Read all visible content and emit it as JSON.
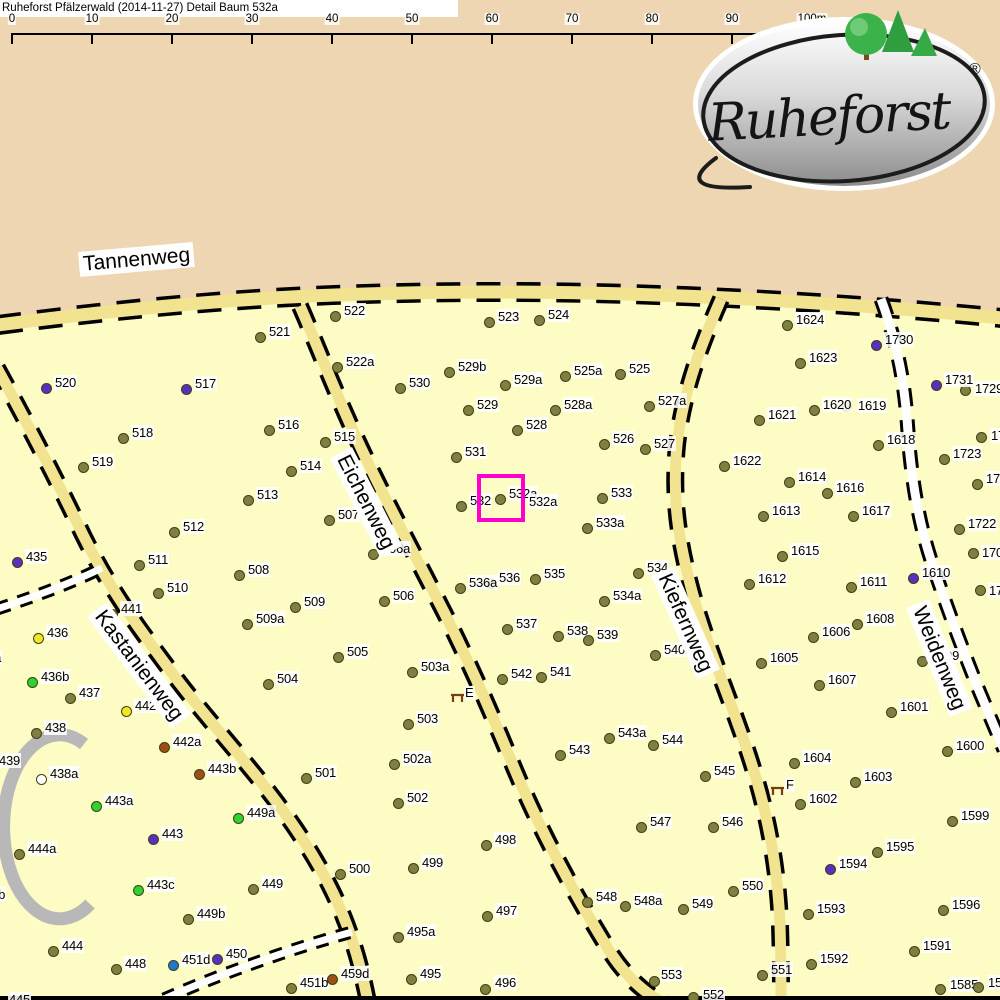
{
  "header": {
    "title": "Ruheforst Pfälzerwald (2014-11-27) Detail  Baum 532a"
  },
  "scale_bar": {
    "tick_labels": [
      "0",
      "10",
      "20",
      "30",
      "40",
      "50",
      "60",
      "70",
      "80",
      "90",
      "100m"
    ],
    "start_x": 12,
    "step_px": 80
  },
  "logo": {
    "text": "Ruheforst",
    "registered": "®"
  },
  "map": {
    "colors": {
      "olive": "#80803e",
      "purple": "#5b2fbe",
      "green": "#2fd32f",
      "yellow": "#f2e623",
      "brown": "#9b4f12",
      "blue": "#2277cc",
      "open": "#ffffff",
      "dot_border": "#3e3e1c",
      "highlight": "#ff00cc",
      "road_yellow": "#f1e38f",
      "forest_bg": "#fcfcc4",
      "outside_bg": "#efd6b2"
    },
    "roads": [
      {
        "name": "Tannenweg",
        "label": {
          "x": 78,
          "y": 252,
          "rot": -5
        }
      },
      {
        "name": "Eichenweg",
        "label": {
          "x": 352,
          "y": 447,
          "rot": 63
        }
      },
      {
        "name": "Kastanienweg",
        "label": {
          "x": 107,
          "y": 602,
          "rot": 53
        }
      },
      {
        "name": "Kiefernweg",
        "label": {
          "x": 674,
          "y": 566,
          "rot": 66
        }
      },
      {
        "name": "Weidenweg",
        "label": {
          "x": 929,
          "y": 599,
          "rot": 68
        }
      }
    ],
    "highlight": {
      "tree": "532a",
      "x": 477,
      "y": 474,
      "w": 48,
      "h": 48
    },
    "benches": [
      {
        "letter": "E",
        "x": 450,
        "y": 692,
        "lx": 464,
        "ly": 686
      },
      {
        "letter": "F",
        "x": 770,
        "y": 785,
        "lx": 785,
        "ly": 778
      }
    ],
    "trees": [
      [
        "435",
        17,
        562,
        "purple"
      ],
      [
        "436",
        38,
        638,
        "yellow"
      ],
      [
        "436a",
        -36,
        663,
        "olive"
      ],
      [
        "436b",
        32,
        682,
        "green"
      ],
      [
        "437",
        70,
        698,
        "olive"
      ],
      [
        "438",
        36,
        733,
        "olive"
      ],
      [
        "438a",
        41,
        779,
        "open"
      ],
      [
        "439",
        -10,
        766,
        "olive"
      ],
      [
        "441",
        112,
        614,
        "brown"
      ],
      [
        "442",
        126,
        711,
        "yellow"
      ],
      [
        "442a",
        164,
        747,
        "brown"
      ],
      [
        "443",
        153,
        839,
        "purple"
      ],
      [
        "443a",
        96,
        806,
        "green"
      ],
      [
        "443b",
        199,
        774,
        "brown"
      ],
      [
        "443c",
        138,
        890,
        "green"
      ],
      [
        "444",
        53,
        951,
        "olive"
      ],
      [
        "444a",
        19,
        854,
        "olive"
      ],
      [
        "444b",
        -32,
        900,
        "olive"
      ],
      [
        "445",
        0,
        1005,
        "olive"
      ],
      [
        "448",
        116,
        969,
        "olive"
      ],
      [
        "449",
        253,
        889,
        "olive"
      ],
      [
        "449a",
        238,
        818,
        "green"
      ],
      [
        "449b",
        188,
        919,
        "olive"
      ],
      [
        "450",
        217,
        959,
        "purple"
      ],
      [
        "451b",
        291,
        988,
        "olive"
      ],
      [
        "451d",
        173,
        965,
        "blue"
      ],
      [
        "459d",
        332,
        979,
        "brown"
      ],
      [
        "495",
        411,
        979,
        "olive"
      ],
      [
        "495a",
        398,
        937,
        "olive"
      ],
      [
        "496",
        485,
        989,
        "olive",
        9,
        -14
      ],
      [
        "497",
        487,
        916,
        "olive"
      ],
      [
        "498",
        486,
        845,
        "olive"
      ],
      [
        "499",
        413,
        868,
        "olive"
      ],
      [
        "500",
        340,
        874,
        "olive"
      ],
      [
        "501",
        306,
        778,
        "olive"
      ],
      [
        "502",
        398,
        803,
        "olive"
      ],
      [
        "502a",
        394,
        764,
        "olive"
      ],
      [
        "503",
        408,
        724,
        "olive"
      ],
      [
        "503a",
        412,
        672,
        "olive"
      ],
      [
        "504",
        268,
        684,
        "olive"
      ],
      [
        "505",
        338,
        657,
        "olive"
      ],
      [
        "506",
        384,
        601,
        "olive"
      ],
      [
        "506a",
        373,
        554,
        "olive"
      ],
      [
        "507",
        329,
        520,
        "olive"
      ],
      [
        "508",
        239,
        575,
        "olive"
      ],
      [
        "509",
        295,
        607,
        "olive"
      ],
      [
        "509a",
        247,
        624,
        "olive"
      ],
      [
        "510",
        158,
        593,
        "olive"
      ],
      [
        "511",
        139,
        565,
        "olive"
      ],
      [
        "512",
        174,
        532,
        "olive"
      ],
      [
        "513",
        248,
        500,
        "olive"
      ],
      [
        "514",
        291,
        471,
        "olive"
      ],
      [
        "515",
        325,
        442,
        "olive"
      ],
      [
        "516",
        269,
        430,
        "olive"
      ],
      [
        "517",
        186,
        389,
        "purple"
      ],
      [
        "518",
        123,
        438,
        "olive"
      ],
      [
        "519",
        83,
        467,
        "olive"
      ],
      [
        "520",
        46,
        388,
        "purple"
      ],
      [
        "521",
        260,
        337,
        "olive"
      ],
      [
        "522",
        335,
        316,
        "olive"
      ],
      [
        "522a",
        337,
        367,
        "olive"
      ],
      [
        "523",
        489,
        322,
        "olive"
      ],
      [
        "524",
        539,
        320,
        "olive"
      ],
      [
        "525",
        620,
        374,
        "olive"
      ],
      [
        "525a",
        565,
        376,
        "olive"
      ],
      [
        "526",
        604,
        444,
        "olive"
      ],
      [
        "527",
        645,
        449,
        "olive"
      ],
      [
        "527a",
        649,
        406,
        "olive"
      ],
      [
        "528",
        517,
        430,
        "olive"
      ],
      [
        "528a",
        555,
        410,
        "olive"
      ],
      [
        "529",
        468,
        410,
        "olive"
      ],
      [
        "529a",
        505,
        385,
        "olive"
      ],
      [
        "529b",
        449,
        372,
        "olive"
      ],
      [
        "530",
        400,
        388,
        "olive"
      ],
      [
        "531",
        456,
        457,
        "olive"
      ],
      [
        "532",
        461,
        506,
        "olive"
      ],
      [
        "532a",
        500,
        499,
        "olive"
      ],
      [
        "532a",
        520,
        507,
        "none"
      ],
      [
        "533",
        602,
        498,
        "olive"
      ],
      [
        "533a",
        587,
        528,
        "olive"
      ],
      [
        "534",
        638,
        573,
        "olive"
      ],
      [
        "534a",
        604,
        601,
        "olive"
      ],
      [
        "535",
        535,
        579,
        "olive"
      ],
      [
        "536",
        490,
        583,
        "olive"
      ],
      [
        "536a",
        460,
        588,
        "olive"
      ],
      [
        "537",
        507,
        629,
        "olive"
      ],
      [
        "538",
        558,
        636,
        "olive"
      ],
      [
        "539",
        588,
        640,
        "olive"
      ],
      [
        "540",
        655,
        655,
        "olive"
      ],
      [
        "541",
        541,
        677,
        "olive"
      ],
      [
        "542",
        502,
        679,
        "olive"
      ],
      [
        "543",
        560,
        755,
        "olive"
      ],
      [
        "543a",
        609,
        738,
        "olive"
      ],
      [
        "544",
        653,
        745,
        "olive"
      ],
      [
        "545",
        705,
        776,
        "olive"
      ],
      [
        "546",
        713,
        827,
        "olive"
      ],
      [
        "547",
        641,
        827,
        "olive"
      ],
      [
        "548",
        587,
        902,
        "olive"
      ],
      [
        "548a",
        625,
        906,
        "olive"
      ],
      [
        "549",
        683,
        909,
        "olive"
      ],
      [
        "550",
        733,
        891,
        "olive"
      ],
      [
        "551",
        762,
        975,
        "olive"
      ],
      [
        "552",
        693,
        997,
        "olive",
        9,
        -10
      ],
      [
        "553",
        654,
        981,
        "olive",
        6,
        -14
      ],
      [
        "1585",
        940,
        989,
        "olive",
        9,
        -12
      ],
      [
        "15",
        978,
        987,
        "olive",
        9,
        -12
      ],
      [
        "1591",
        914,
        951,
        "olive"
      ],
      [
        "1592",
        811,
        964,
        "olive"
      ],
      [
        "1593",
        808,
        914,
        "olive"
      ],
      [
        "1594",
        830,
        869,
        "purple"
      ],
      [
        "1595",
        877,
        852,
        "olive"
      ],
      [
        "1596",
        943,
        910,
        "olive"
      ],
      [
        "1599",
        952,
        821,
        "olive"
      ],
      [
        "1600",
        947,
        751,
        "olive"
      ],
      [
        "1601",
        891,
        712,
        "olive"
      ],
      [
        "1602",
        800,
        804,
        "olive"
      ],
      [
        "1603",
        855,
        782,
        "olive"
      ],
      [
        "1604",
        794,
        763,
        "olive"
      ],
      [
        "1605",
        761,
        663,
        "olive"
      ],
      [
        "1606",
        813,
        637,
        "olive"
      ],
      [
        "1607",
        819,
        685,
        "olive"
      ],
      [
        "1608",
        857,
        624,
        "olive"
      ],
      [
        "1609",
        922,
        661,
        "olive"
      ],
      [
        "1610",
        913,
        578,
        "purple"
      ],
      [
        "1611",
        851,
        587,
        "olive"
      ],
      [
        "1612",
        749,
        584,
        "olive"
      ],
      [
        "1613",
        763,
        516,
        "olive"
      ],
      [
        "1614",
        789,
        482,
        "olive"
      ],
      [
        "1615",
        782,
        556,
        "olive"
      ],
      [
        "1616",
        827,
        493,
        "olive"
      ],
      [
        "1617",
        853,
        516,
        "olive"
      ],
      [
        "1618",
        878,
        445,
        "olive"
      ],
      [
        "1619",
        846,
        406,
        "olive",
        11,
        -8
      ],
      [
        "1620",
        814,
        410,
        "olive"
      ],
      [
        "1621",
        759,
        420,
        "olive"
      ],
      [
        "1622",
        724,
        466,
        "olive"
      ],
      [
        "1623",
        800,
        363,
        "olive"
      ],
      [
        "1624",
        787,
        325,
        "olive"
      ],
      [
        "1722",
        959,
        529,
        "olive"
      ],
      [
        "1723",
        944,
        459,
        "olive"
      ],
      [
        "1729",
        965,
        390,
        "olive",
        9,
        -9
      ],
      [
        "1730",
        876,
        345,
        "purple"
      ],
      [
        "1731",
        936,
        385,
        "purple"
      ],
      [
        "17",
        981,
        437,
        "olive",
        9,
        -9
      ],
      [
        "172",
        977,
        484,
        "olive",
        8,
        -13
      ],
      [
        "170",
        973,
        553,
        "olive",
        8,
        -8
      ],
      [
        "17",
        980,
        590,
        "olive",
        8,
        -7
      ]
    ]
  }
}
